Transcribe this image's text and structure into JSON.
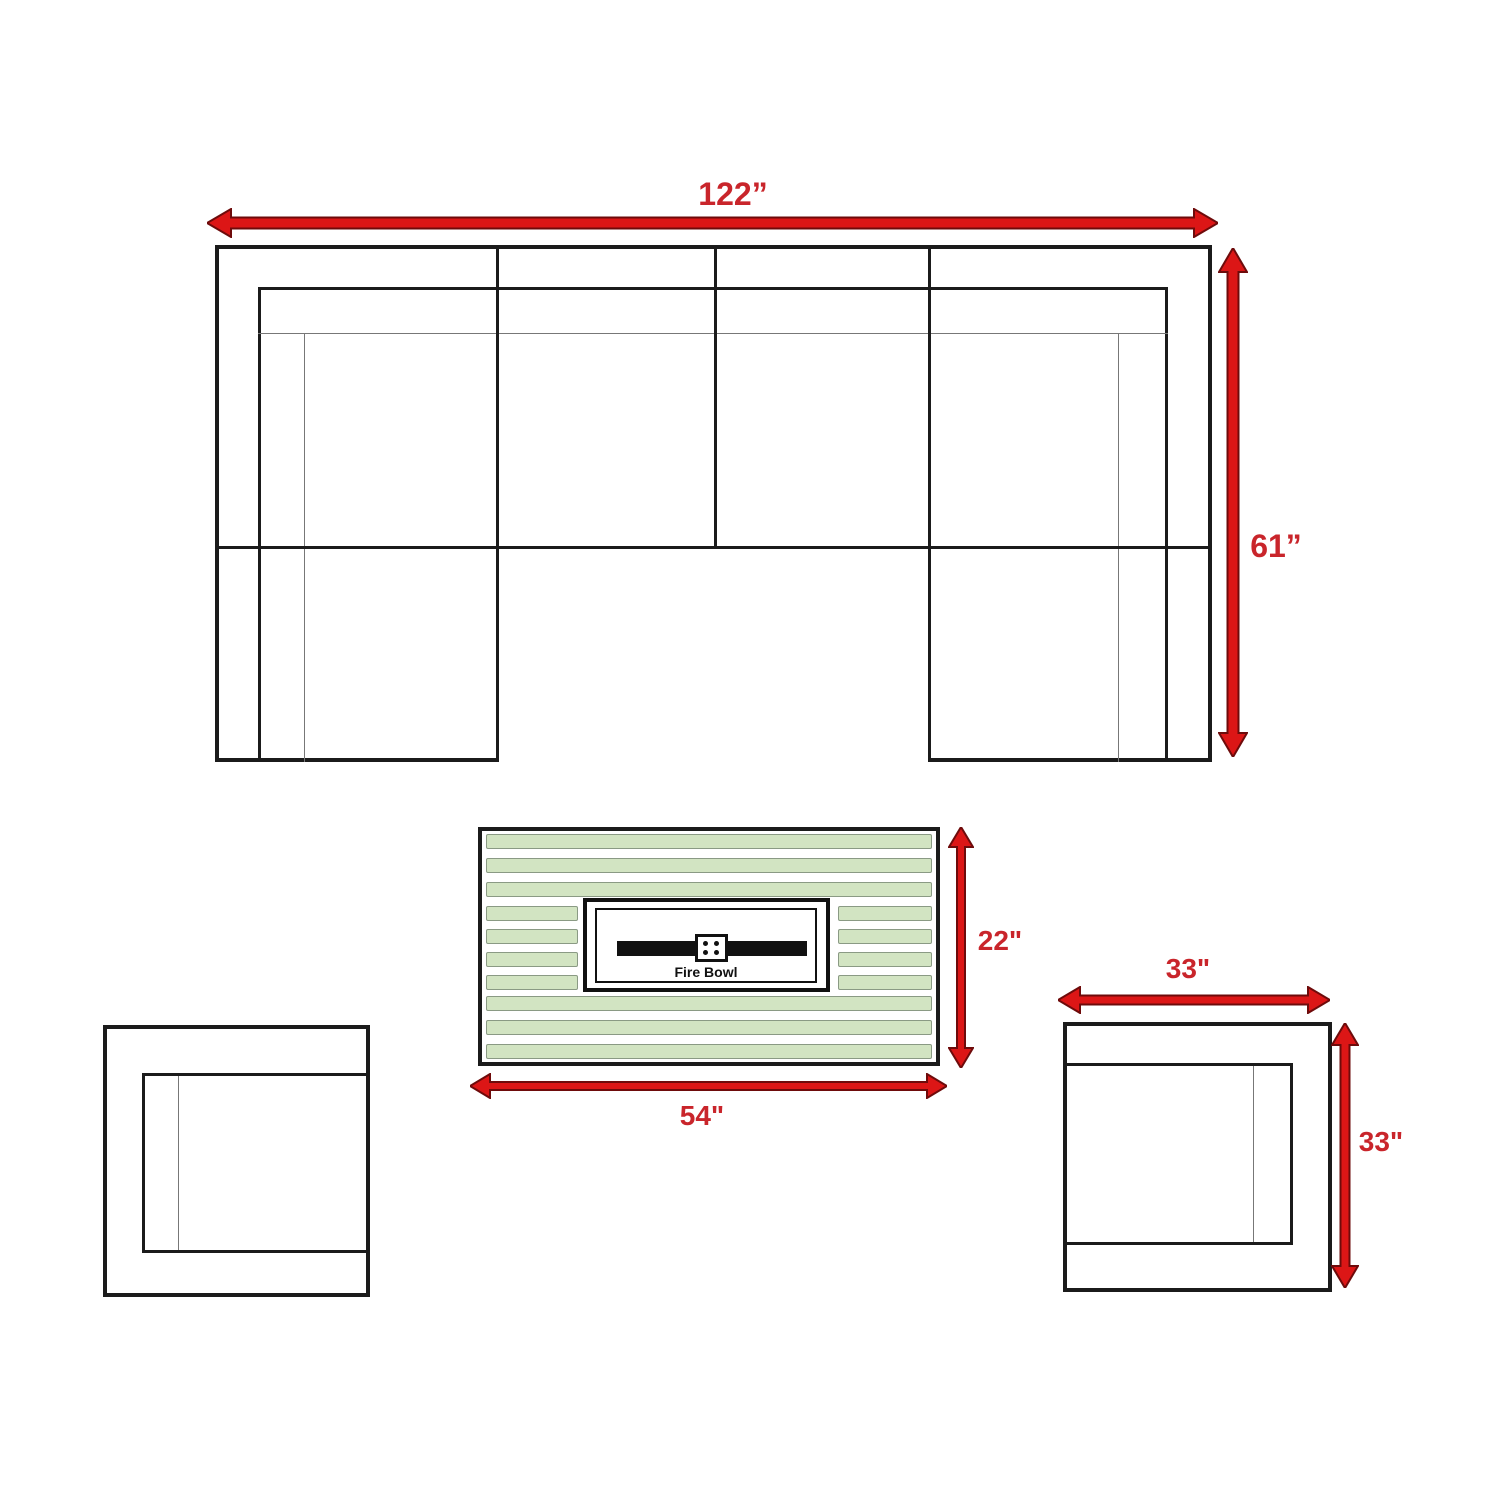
{
  "sectional": {
    "width_label": "122”",
    "depth_label": "61”"
  },
  "fire_table": {
    "width_label": "22\"",
    "length_label": "54\"",
    "burner_label": "Fire Bowl"
  },
  "chair": {
    "width_label": "33\"",
    "depth_label": "33\""
  },
  "colors": {
    "arrow_red": "#dc1616",
    "arrow_outline": "#6e0b0b",
    "label_red": "#c9252b",
    "outline_black": "#1b1b1b",
    "cushion_line_gray": "#777777",
    "slat_green_fill": "#d2e4c2",
    "slat_green_border": "#8a9a84"
  }
}
